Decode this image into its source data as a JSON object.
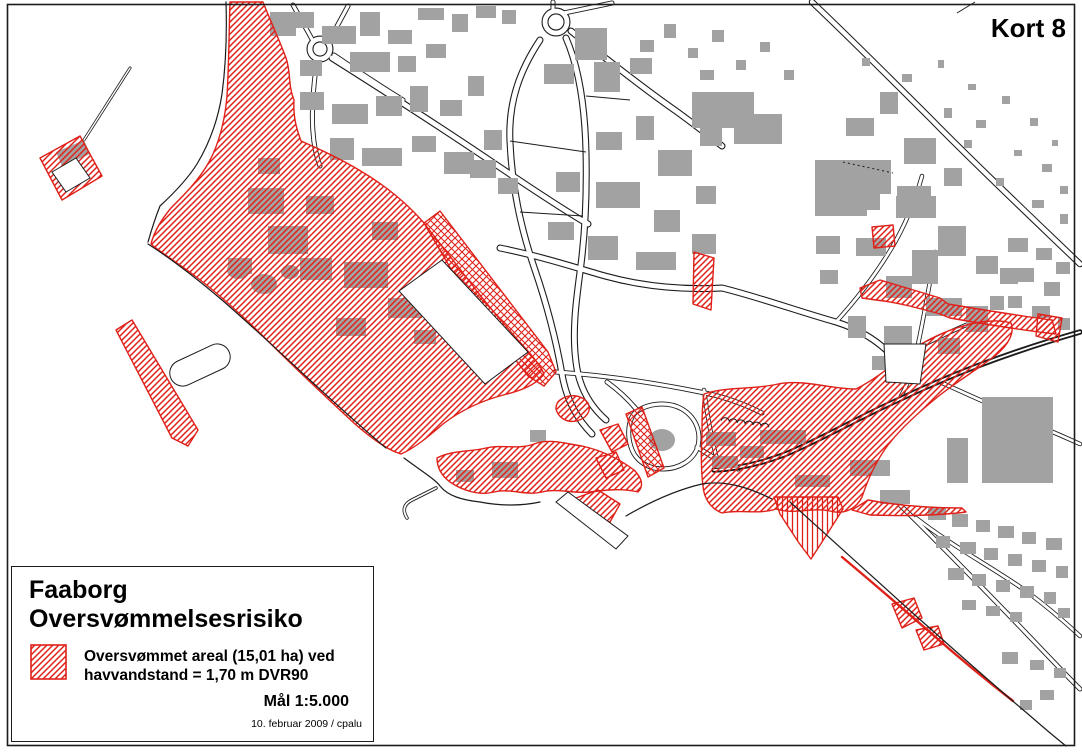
{
  "sheet": {
    "label": "Kort 8"
  },
  "legend": {
    "title_line1": "Faaborg",
    "title_line2": "Oversvømmelsesrisiko",
    "item": {
      "swatch": "red-diagonal-hatch-swatch",
      "line1": "Oversvømmet areal (15,01 ha) ved",
      "line2": "havvandstand = 1,70 m DVR90"
    },
    "scale": "Mål 1:5.000",
    "credit": "10. februar 2009 / cpalu"
  },
  "colors": {
    "flood_red": "#df2119",
    "building_gray": "#a2a2a2",
    "line_black": "#1c1c1c",
    "background": "#ffffff"
  }
}
